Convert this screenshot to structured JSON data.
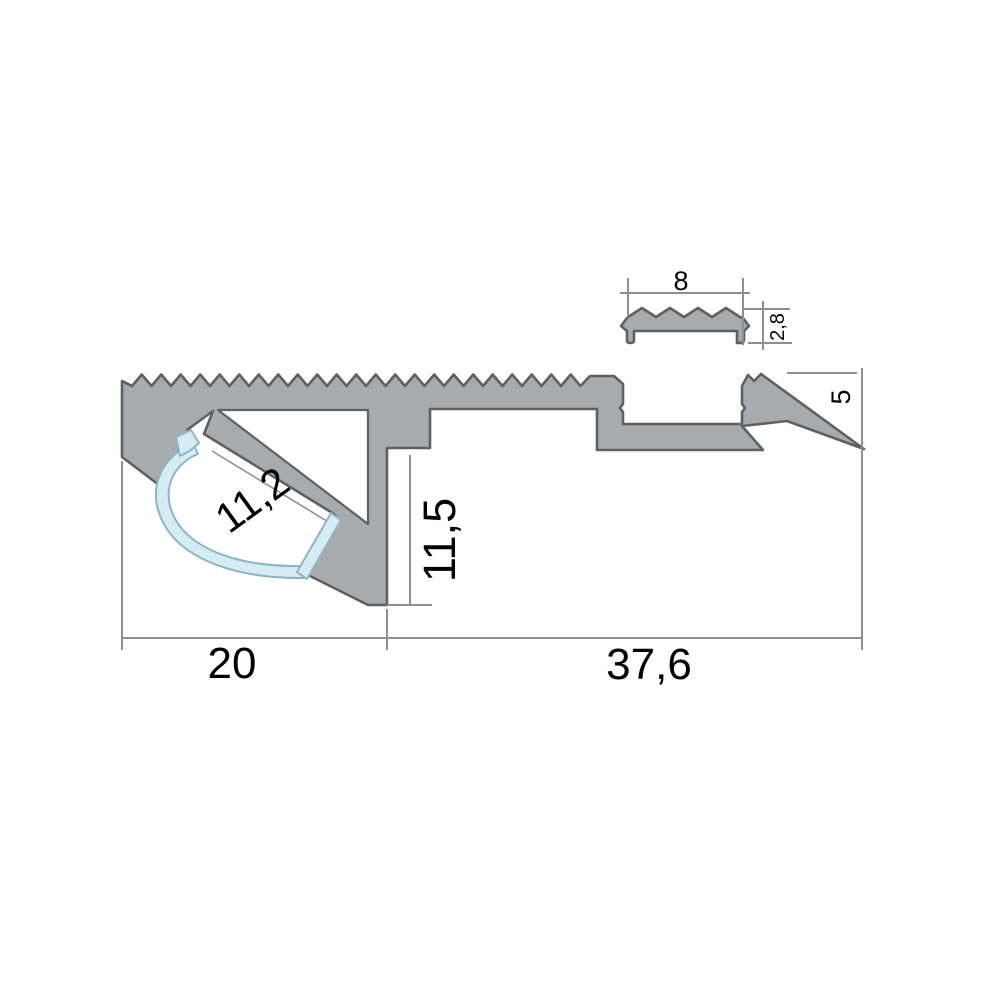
{
  "drawing": {
    "title": "led-stair-nosing-profile-cross-section",
    "dimensions": {
      "insert_width": "8",
      "insert_height": "2,8",
      "rear_edge_height": "5",
      "led_channel_width": "11,2",
      "front_height": "11,5",
      "nose_width": "20",
      "tread_width": "37,6"
    },
    "colors": {
      "profile_fill": "#a7abae",
      "profile_stroke": "#5d6164",
      "diffuser_fill": "#d6ecf5",
      "diffuser_stroke": "#8fb5c3",
      "dimension_line": "#8d9093",
      "text": "#000000",
      "background": "#ffffff"
    }
  }
}
